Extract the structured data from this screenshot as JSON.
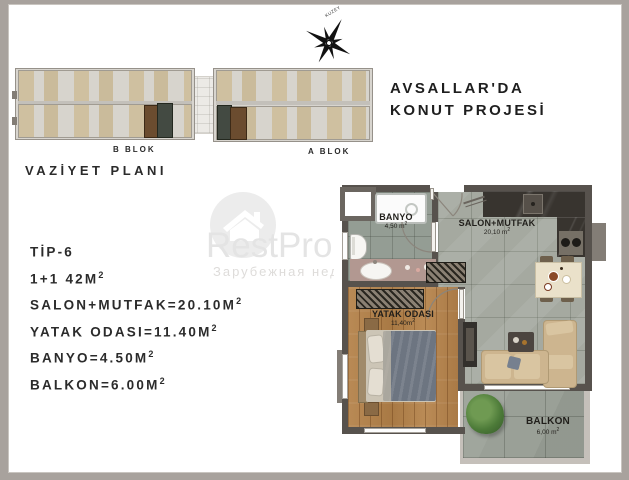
{
  "page": {
    "title_line1": "AVSALLAR'DA",
    "title_line2": "KONUT PROJESİ",
    "site_plan_label": "VAZİYET PLANI",
    "block_b_label": "B BLOK",
    "block_a_label": "A BLOK",
    "compass_label": "KUZEY"
  },
  "specs": {
    "lines": [
      {
        "text": "TİP-6",
        "sup": ""
      },
      {
        "text": "1+1 42M",
        "sup": "2"
      },
      {
        "text": "SALON+MUTFAK=20.10M",
        "sup": "2"
      },
      {
        "text": "YATAK ODASI=11.40M",
        "sup": "2"
      },
      {
        "text": "BANYO=4.50M",
        "sup": "2"
      },
      {
        "text": "BALKON=6.00M",
        "sup": "2"
      }
    ]
  },
  "floor_plan": {
    "rooms": [
      {
        "name": "BANYO",
        "area": "4,50 m",
        "sup": "2"
      },
      {
        "name": "SALON+MUTFAK",
        "area": "20,10 m",
        "sup": "2"
      },
      {
        "name": "YATAK ODASI",
        "area": "11,40m",
        "sup": "2"
      },
      {
        "name": "BALKON",
        "area": "6,00 m",
        "sup": "2"
      }
    ]
  },
  "watermark": {
    "brand": "RestProperty",
    "subtitle": "Зарубежная недвижимость"
  },
  "colors": {
    "wall": "#57524d",
    "salon_tile": "#a5a9a0",
    "bath_tile": "#949d94",
    "wood_floor": "#b3834e",
    "highlight_brown": "#6b4c2f",
    "highlight_dark": "#434a42"
  }
}
